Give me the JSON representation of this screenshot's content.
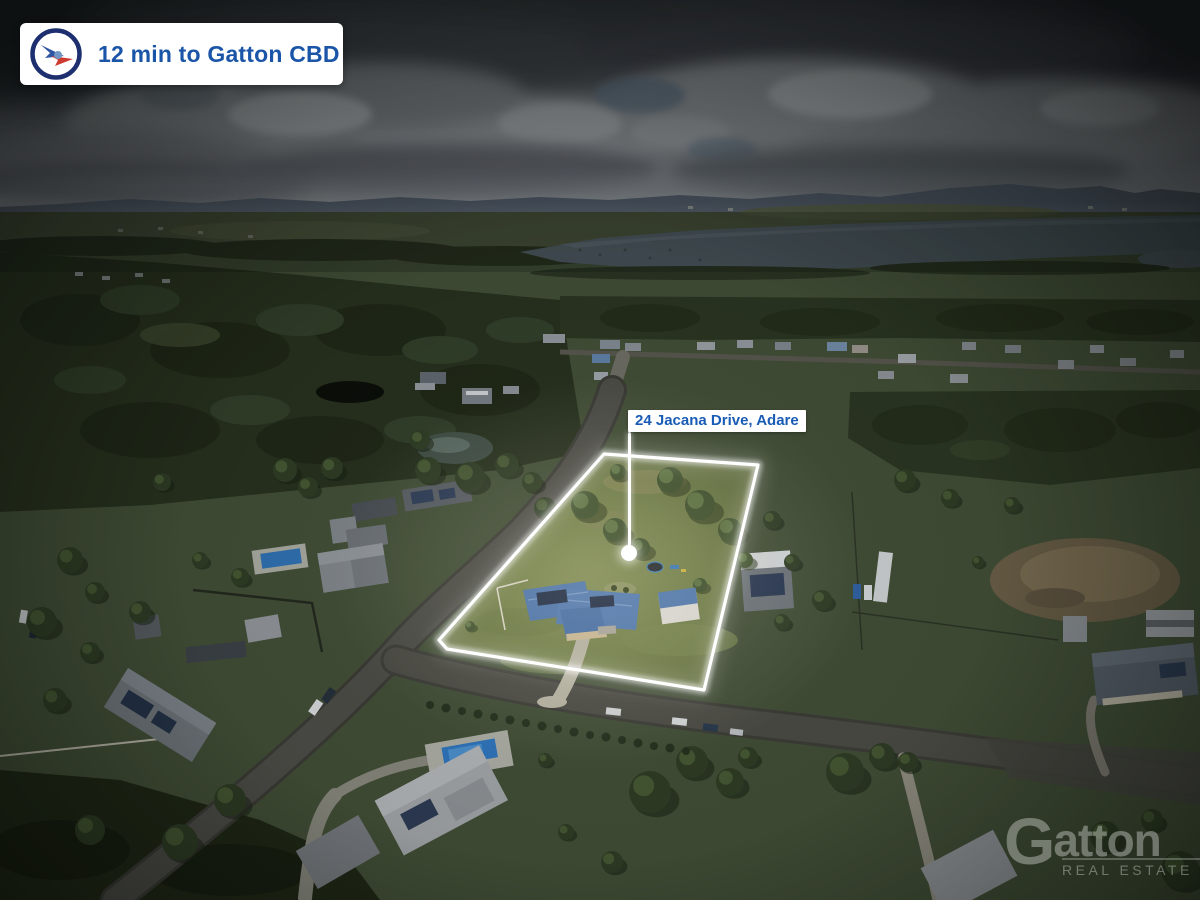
{
  "overlays": {
    "badge": {
      "text": "12 min to Gatton CBD",
      "text_color": "#1a55a8",
      "icon": "compass-logo-icon",
      "background": "#ffffff"
    },
    "property_label": {
      "text": "24 Jacana Drive, Adare",
      "text_color": "#1a5cb5",
      "background": "#ffffff",
      "pointer_color": "#ffffff"
    },
    "watermark": {
      "brand_initial": "G",
      "brand_rest": "atton",
      "tagline": "REAL ESTATE"
    }
  },
  "scene": {
    "type": "aerial-drone-photograph",
    "boundary_color": "#ffffff",
    "highlight": "property lot outlined in white, surroundings darkened by vignette"
  }
}
